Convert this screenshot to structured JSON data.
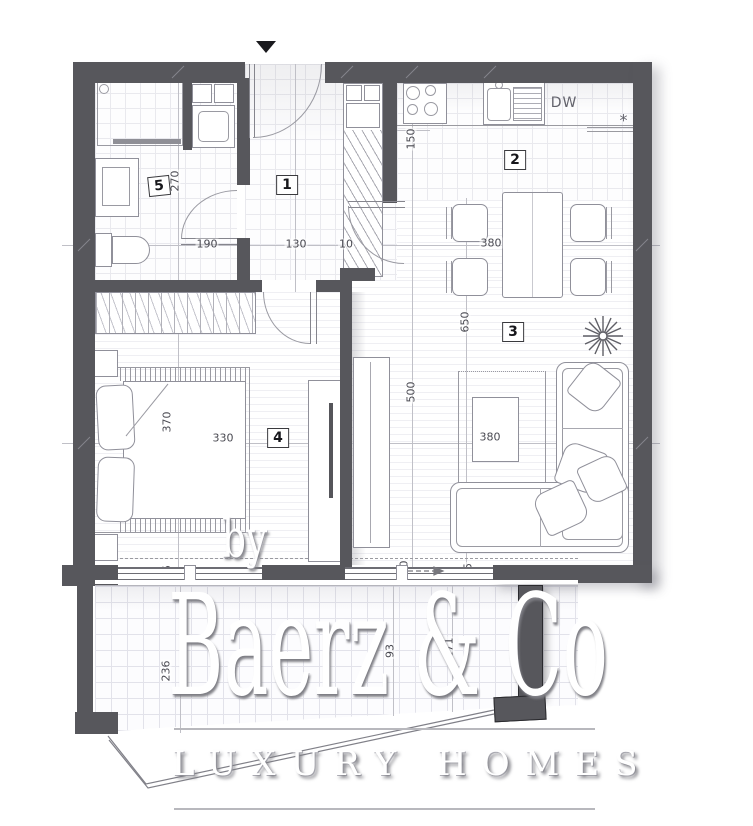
{
  "watermark": {
    "by": "by",
    "brand": "Baerz & Co",
    "tagline": "LUXURY HOMES"
  },
  "kitchen": {
    "dishwasher_label": "DW",
    "corner_mark": "*"
  },
  "colors": {
    "wall": "#57575c",
    "furniture_line": "#90909a",
    "dimension_text": "#4a4a52",
    "grid": "#e9e9ee",
    "watermark_fill": "#ffffff",
    "watermark_shadow": "#7d7d84"
  },
  "icons": [
    "entry-direction-arrow",
    "plant-icon",
    "slide-direction-arrow"
  ],
  "room_labels": [
    {
      "number": "1",
      "x": 287,
      "y": 185,
      "tilt": 0
    },
    {
      "number": "2",
      "x": 515,
      "y": 160,
      "tilt": 0
    },
    {
      "number": "3",
      "x": 513,
      "y": 332,
      "tilt": 0
    },
    {
      "number": "4",
      "x": 278,
      "y": 438,
      "tilt": 0
    },
    {
      "number": "5",
      "x": 159,
      "y": 186,
      "tilt": -6
    }
  ],
  "dimension_labels": [
    {
      "text": "270",
      "x": 175,
      "y": 181,
      "rotated": true
    },
    {
      "text": "190",
      "x": 207,
      "y": 244,
      "rotated": false
    },
    {
      "text": "130",
      "x": 296,
      "y": 244,
      "rotated": false
    },
    {
      "text": "10",
      "x": 346,
      "y": 244,
      "rotated": false
    },
    {
      "text": "150",
      "x": 411,
      "y": 139,
      "rotated": true
    },
    {
      "text": "380",
      "x": 491,
      "y": 243,
      "rotated": false
    },
    {
      "text": "650",
      "x": 465,
      "y": 322,
      "rotated": true
    },
    {
      "text": "500",
      "x": 411,
      "y": 392,
      "rotated": true
    },
    {
      "text": "380",
      "x": 490,
      "y": 437,
      "rotated": false
    },
    {
      "text": "370",
      "x": 167,
      "y": 422,
      "rotated": true
    },
    {
      "text": "330",
      "x": 223,
      "y": 438,
      "rotated": false
    },
    {
      "text": "15",
      "x": 167,
      "y": 572,
      "rotated": true
    },
    {
      "text": "250",
      "x": 404,
      "y": 571,
      "rotated": true
    },
    {
      "text": "25",
      "x": 468,
      "y": 570,
      "rotated": true
    },
    {
      "text": "236",
      "x": 166,
      "y": 671,
      "rotated": true
    },
    {
      "text": "93",
      "x": 390,
      "y": 651,
      "rotated": true
    },
    {
      "text": "171",
      "x": 449,
      "y": 648,
      "rotated": true
    }
  ]
}
